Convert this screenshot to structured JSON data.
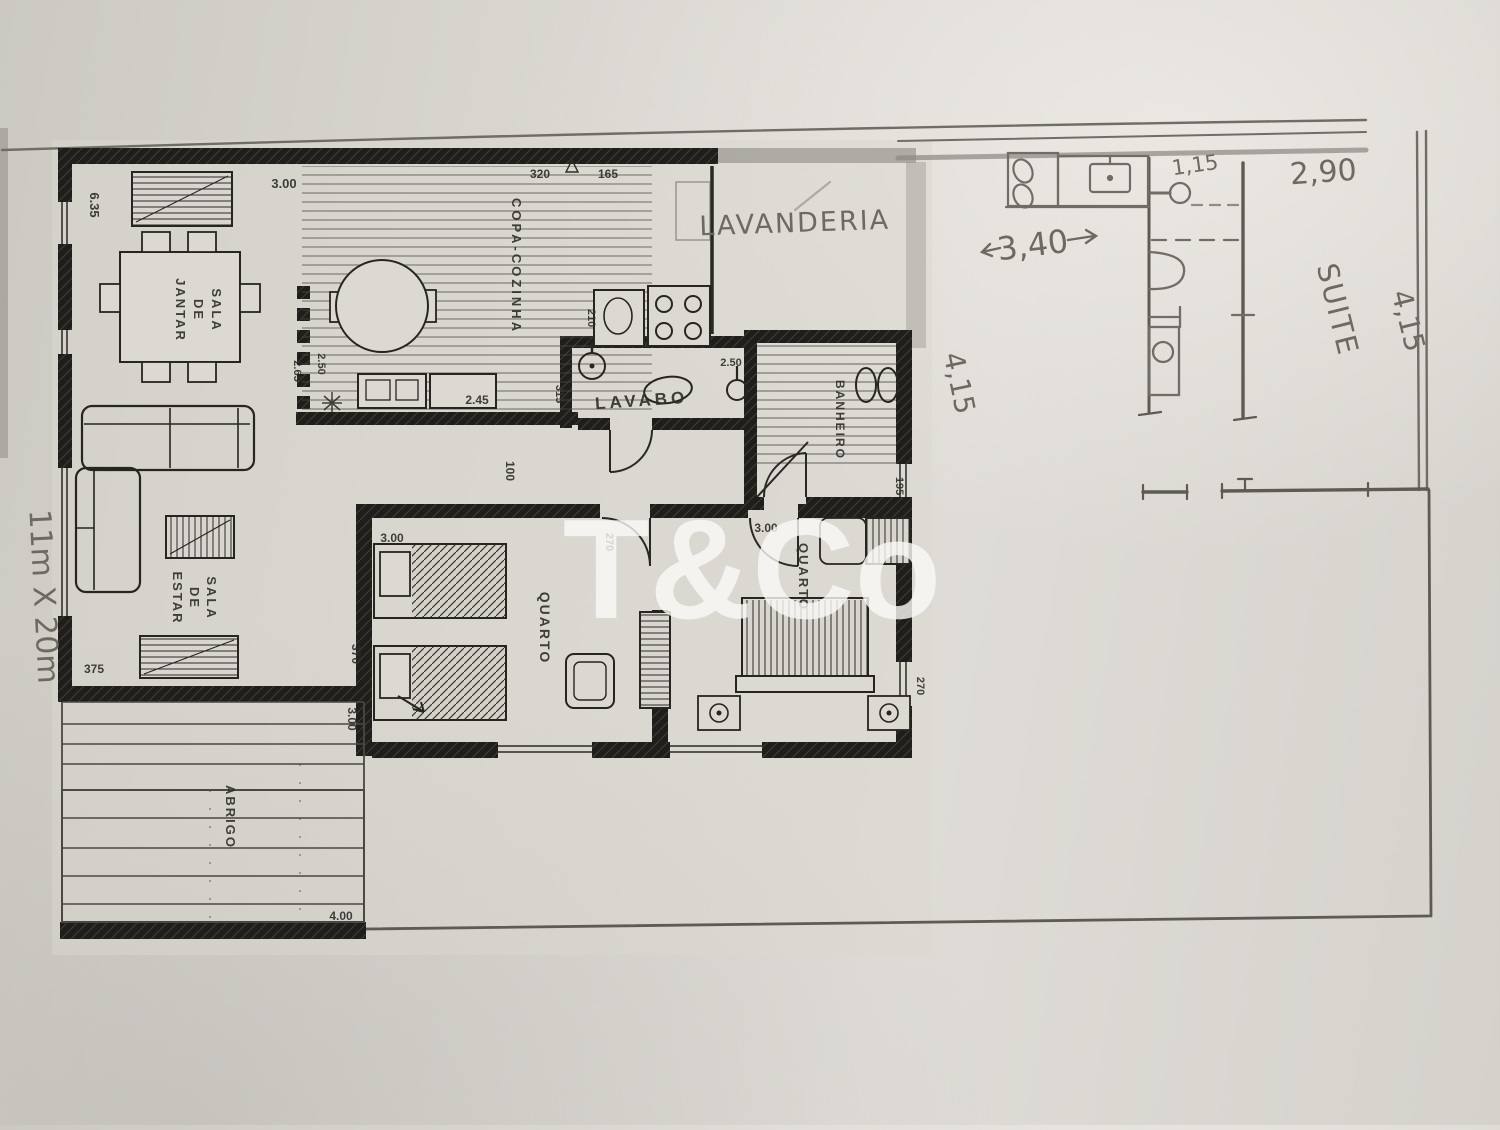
{
  "watermark": "T&Co",
  "handwritten": {
    "lavanderia": "LAVANDERIA",
    "ext_width": "1,15",
    "suite_width": "2,90",
    "laundry_width": "3,40",
    "laundry_depth": "4,15",
    "suite_name": "SUITE",
    "suite_depth": "4,15",
    "lot_size": "11m X 20m"
  },
  "printed": {
    "rooms": {
      "sala_de_jantar": [
        "SALA",
        "DE",
        "JANTAR"
      ],
      "sala_de_estar": [
        "SALA",
        "DE",
        "ESTAR"
      ],
      "copa_cozinha": "COPA-COZINHA",
      "lavabo": "LAVABO",
      "banheiro": "BANHEIRO",
      "quarto_left": "QUARTO",
      "quarto_right": "QUARTO",
      "abrigo": "ABRIGO"
    },
    "dimensions": {
      "left_wall": "6.35",
      "jantar_width": "3.00",
      "kitchen_top_a": "320",
      "kitchen_top_b": "165",
      "kitchen_door_a": "2.50",
      "kitchen_door_b": "2.65",
      "counter": "2.45",
      "lavabo_depth": "315",
      "sink_run": "210",
      "shower": "2.50",
      "bath_window": "195",
      "hall": "100",
      "quarto_left_width": "3.00",
      "quarto_left_depth": "370",
      "quarto_low": "3.00",
      "estar": "375",
      "hall_end": "270",
      "quarto_right_window": "270",
      "quarto_right_width": "3.00",
      "abrigo_width": "4.00"
    }
  }
}
